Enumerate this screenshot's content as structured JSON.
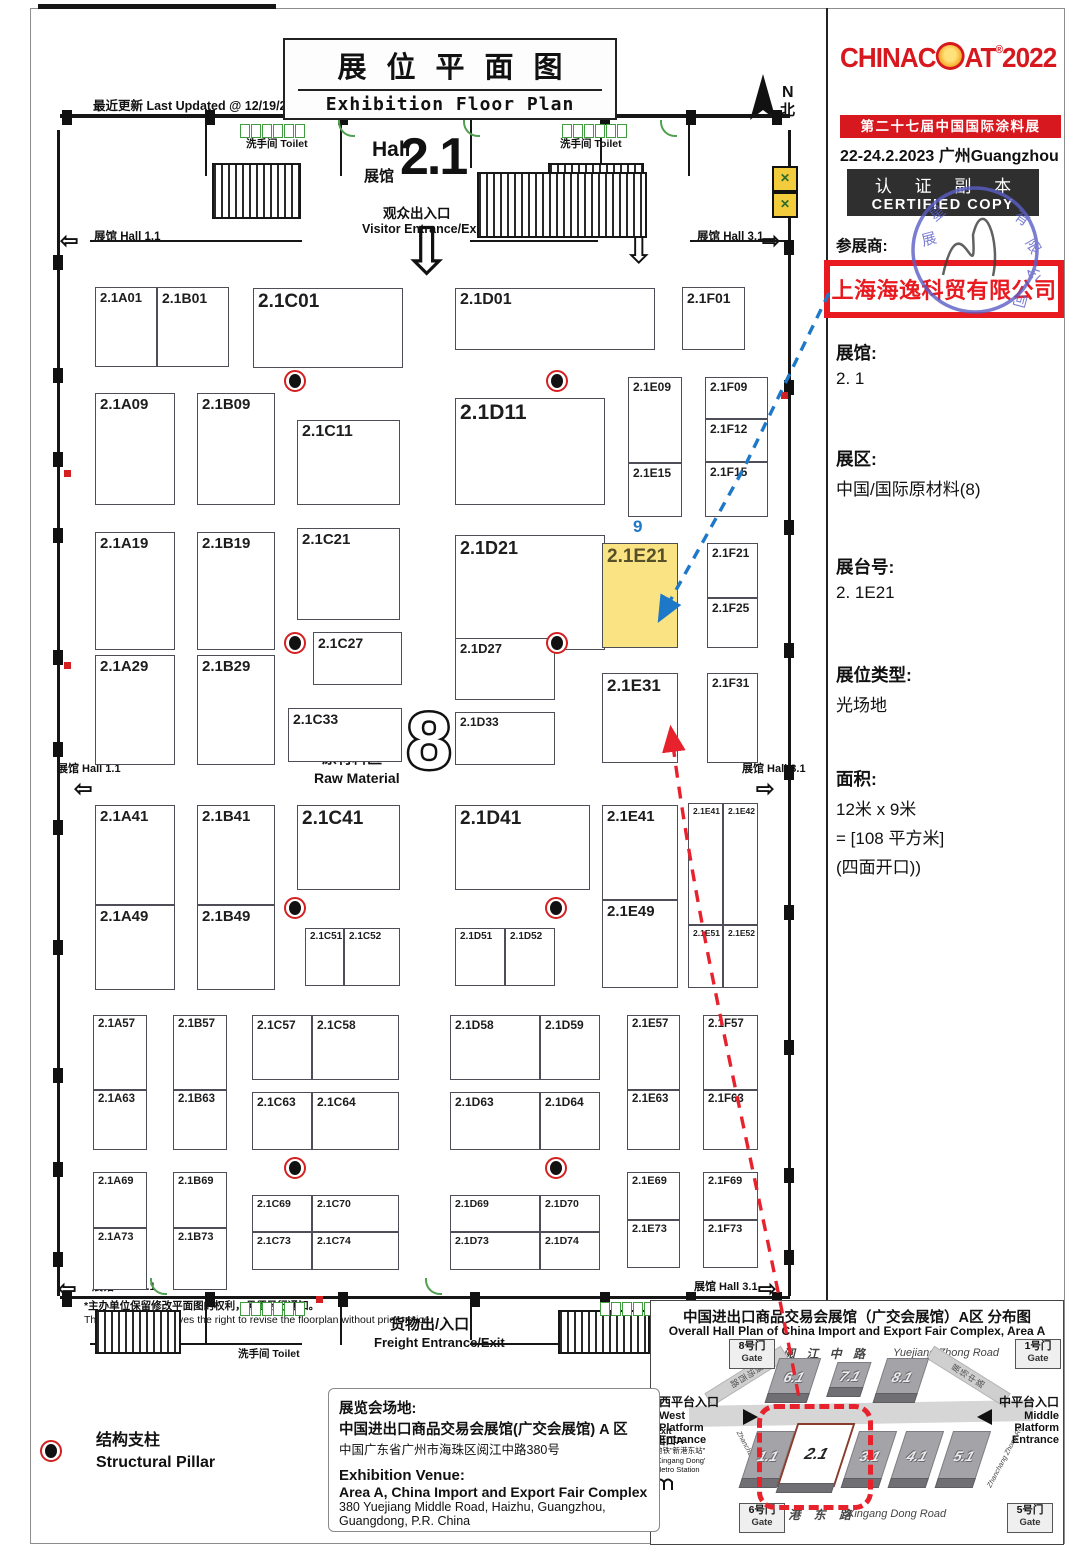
{
  "header": {
    "last_updated": "最近更新 Last Updated @ 12/19/2022",
    "title_cn": "展位平面图",
    "title_en": "Exhibition Floor Plan",
    "hall_word": "Hall",
    "hall_word_cn": "展馆",
    "hall_number": "2.1",
    "visitor_cn": "观众出入口",
    "visitor_en": "Visitor Entrance/Exit",
    "north_n": "N",
    "north_cn": "北"
  },
  "nav": {
    "hall11": "展馆 Hall 1.1",
    "hall31": "展馆 Hall 3.1"
  },
  "floorplan": {
    "toilet": "洗手间  Toilet",
    "freight_cn": "货物出/入口",
    "freight_en": "Freight Entrance/Exit",
    "zone_number": "8",
    "zone_cn": "原材料区",
    "zone_en": "Raw Material",
    "dim_top": "9",
    "dim_left": "12",
    "booths": [
      [
        "2.1A01",
        95,
        287,
        62,
        80,
        13
      ],
      [
        "2.1B01",
        157,
        287,
        72,
        80,
        14
      ],
      [
        "2.1C01",
        253,
        288,
        150,
        80,
        19
      ],
      [
        "2.1D01",
        455,
        288,
        200,
        62,
        16
      ],
      [
        "2.1F01",
        682,
        287,
        63,
        63,
        14
      ],
      [
        "2.1A09",
        95,
        393,
        80,
        112,
        15
      ],
      [
        "2.1B09",
        197,
        393,
        78,
        112,
        15
      ],
      [
        "2.1C11",
        297,
        420,
        103,
        85,
        16
      ],
      [
        "2.1D11",
        455,
        398,
        150,
        107,
        21
      ],
      [
        "2.1E09",
        628,
        377,
        54,
        86,
        12
      ],
      [
        "2.1E15",
        628,
        463,
        54,
        54,
        12
      ],
      [
        "2.1F09",
        705,
        377,
        63,
        42,
        12
      ],
      [
        "2.1F12",
        705,
        419,
        63,
        43,
        12
      ],
      [
        "2.1F15",
        705,
        462,
        63,
        55,
        12
      ],
      [
        "2.1A19",
        95,
        532,
        80,
        118,
        15
      ],
      [
        "2.1B19",
        197,
        532,
        78,
        118,
        15
      ],
      [
        "2.1C21",
        297,
        528,
        103,
        92,
        15
      ],
      [
        "2.1D21",
        455,
        535,
        150,
        115,
        18
      ],
      [
        "2.1E21",
        602,
        543,
        76,
        105,
        19,
        1
      ],
      [
        "2.1F21",
        707,
        543,
        51,
        55,
        12
      ],
      [
        "2.1F25",
        707,
        598,
        51,
        50,
        12
      ],
      [
        "2.1A29",
        95,
        655,
        80,
        110,
        15
      ],
      [
        "2.1B29",
        197,
        655,
        78,
        110,
        15
      ],
      [
        "2.1C27",
        313,
        632,
        89,
        53,
        14
      ],
      [
        "2.1C33",
        288,
        708,
        114,
        54,
        14
      ],
      [
        "2.1D27",
        455,
        638,
        100,
        62,
        13
      ],
      [
        "2.1D33",
        455,
        712,
        100,
        53,
        12
      ],
      [
        "2.1E31",
        602,
        673,
        76,
        90,
        17
      ],
      [
        "2.1F31",
        707,
        673,
        51,
        90,
        12
      ],
      [
        "2.1A41",
        95,
        805,
        80,
        100,
        15
      ],
      [
        "2.1A49",
        95,
        905,
        80,
        85,
        15
      ],
      [
        "2.1B41",
        197,
        805,
        78,
        100,
        15
      ],
      [
        "2.1B49",
        197,
        905,
        78,
        85,
        15
      ],
      [
        "2.1C41",
        297,
        805,
        103,
        85,
        19
      ],
      [
        "2.1C51",
        305,
        928,
        39,
        58,
        10
      ],
      [
        "2.1C52",
        344,
        928,
        56,
        58,
        10
      ],
      [
        "2.1D41",
        455,
        805,
        135,
        85,
        19
      ],
      [
        "2.1D51",
        455,
        928,
        50,
        58,
        10
      ],
      [
        "2.1D52",
        505,
        928,
        50,
        58,
        10
      ],
      [
        "2.1E41",
        602,
        805,
        76,
        95,
        15
      ],
      [
        "2.1E49",
        602,
        900,
        76,
        88,
        15
      ],
      [
        "2.1E41",
        688,
        803,
        35,
        122,
        8.5
      ],
      [
        "2.1E42",
        723,
        803,
        35,
        122,
        8.5
      ],
      [
        "2.1E51",
        688,
        925,
        35,
        63,
        8.5
      ],
      [
        "2.1E52",
        723,
        925,
        35,
        63,
        8.5
      ],
      [
        "2.1A57",
        93,
        1015,
        54,
        75,
        11.5
      ],
      [
        "2.1A63",
        93,
        1090,
        54,
        60,
        11.5
      ],
      [
        "2.1B57",
        173,
        1015,
        54,
        75,
        11.5
      ],
      [
        "2.1B63",
        173,
        1090,
        54,
        60,
        11.5
      ],
      [
        "2.1C57",
        252,
        1015,
        60,
        65,
        12
      ],
      [
        "2.1C58",
        312,
        1015,
        87,
        65,
        12
      ],
      [
        "2.1C63",
        252,
        1092,
        60,
        58,
        12
      ],
      [
        "2.1C64",
        312,
        1092,
        87,
        58,
        12
      ],
      [
        "2.1D58",
        450,
        1015,
        90,
        65,
        12
      ],
      [
        "2.1D59",
        540,
        1015,
        60,
        65,
        12
      ],
      [
        "2.1D63",
        450,
        1092,
        90,
        58,
        12
      ],
      [
        "2.1D64",
        540,
        1092,
        60,
        58,
        12
      ],
      [
        "2.1E57",
        627,
        1015,
        53,
        75,
        11.5
      ],
      [
        "2.1E63",
        627,
        1090,
        53,
        60,
        11.5
      ],
      [
        "2.1F57",
        703,
        1015,
        55,
        75,
        11.5
      ],
      [
        "2.1F63",
        703,
        1090,
        55,
        60,
        11.5
      ],
      [
        "2.1A69",
        93,
        1172,
        54,
        56,
        11
      ],
      [
        "2.1A73",
        93,
        1228,
        54,
        62,
        11
      ],
      [
        "2.1B69",
        173,
        1172,
        54,
        56,
        11
      ],
      [
        "2.1B73",
        173,
        1228,
        54,
        62,
        11
      ],
      [
        "2.1C69",
        252,
        1195,
        60,
        37,
        10.5
      ],
      [
        "2.1C70",
        312,
        1195,
        87,
        37,
        10.5
      ],
      [
        "2.1C73",
        252,
        1232,
        60,
        38,
        10.5
      ],
      [
        "2.1C74",
        312,
        1232,
        87,
        38,
        10.5
      ],
      [
        "2.1D69",
        450,
        1195,
        90,
        37,
        10.5
      ],
      [
        "2.1D70",
        540,
        1195,
        60,
        37,
        10.5
      ],
      [
        "2.1D73",
        450,
        1232,
        90,
        38,
        10.5
      ],
      [
        "2.1D74",
        540,
        1232,
        60,
        38,
        10.5
      ],
      [
        "2.1E69",
        627,
        1172,
        53,
        48,
        11
      ],
      [
        "2.1E73",
        627,
        1220,
        53,
        48,
        11
      ],
      [
        "2.1F69",
        703,
        1172,
        55,
        48,
        11
      ],
      [
        "2.1F73",
        703,
        1220,
        55,
        48,
        11
      ]
    ],
    "pillars": [
      [
        295,
        381
      ],
      [
        557,
        381
      ],
      [
        295,
        643
      ],
      [
        557,
        643
      ],
      [
        295,
        908
      ],
      [
        556,
        908
      ],
      [
        295,
        1168
      ],
      [
        556,
        1168
      ]
    ]
  },
  "legend": {
    "pillar_cn": "结构支柱",
    "pillar_en": "Structural Pillar"
  },
  "footnote": {
    "cn": "*主办单位保留修改平面图的权利，毋须另行通知。",
    "en": "The Organizer reserves the right to revise the floorplan without prior notice."
  },
  "venue": {
    "cn_label": "展览会场地:",
    "cn_line1": "中国进出口商品交易会展馆(广交会展馆) A 区",
    "cn_line2": "中国广东省广州市海珠区阅江中路380号",
    "en_label": "Exhibition Venue:",
    "en_line1": "Area A, China Import and Export Fair Complex",
    "en_line2": "380 Yuejiang Middle Road, Haizhu, Guangzhou,",
    "en_line3": "Guangdong, P.R. China"
  },
  "sidebar": {
    "logo_left": "CHINAC",
    "logo_right": "AT",
    "logo_reg": "®",
    "logo_year": "2022",
    "logo_sub": "第二十七届中国国际涂料展",
    "date_line": "22-24.2.2023 广州Guangzhou",
    "certified_cn": "认 证 副 本",
    "certified_en": "CERTIFIED COPY",
    "exhibitor_label": "参展商:",
    "company": "上海海逸科贸有限公司",
    "fields": [
      {
        "label": "展馆:",
        "lines": [
          "2. 1"
        ]
      },
      {
        "label": "展区:",
        "lines": [
          "中国/国际原材料(8)"
        ]
      },
      {
        "label": "展台号:",
        "lines": [
          "2. 1E21"
        ]
      },
      {
        "label": "展位类型:",
        "lines": [
          "光场地"
        ]
      },
      {
        "label": "面积:",
        "lines": [
          "12米 x 9米",
          "= [108 平方米]",
          "(四面开口))"
        ]
      }
    ]
  },
  "minimap": {
    "title_cn": "中国进出口商品交易会展馆（广交会展馆）A区 分布图",
    "title_en": "Overall Hall Plan of China Import and Export Fair Complex, Area A",
    "gate_tl": {
      "cn": "8号门",
      "en": "Gate"
    },
    "gate_tr": {
      "cn": "1号门",
      "en": "Gate"
    },
    "gate_bl": {
      "cn": "6号门",
      "en": "Gate"
    },
    "gate_br": {
      "cn": "5号门",
      "en": "Gate"
    },
    "road_top_cn": "阅 江 中 路",
    "road_top_en": "Yuejiang Zhong Road",
    "promenade_cn": "珠 江 散 步 道",
    "promenade_en": "Pearl Promenade",
    "road_bottom_cn": "新 港 东 路",
    "road_bottom_en": "Xingang Dong Road",
    "side_left_cn": "展场西路",
    "side_left_en": "Zhanchang Xi Rd.",
    "side_right_cn": "展场中路",
    "side_right_en": "Zhanchang Zhong Rd.",
    "west_cn": "西平台入口",
    "west_en": [
      "West",
      "Platform",
      "Entrance"
    ],
    "mid_cn": "中平台入口",
    "mid_en": [
      "Middle",
      "Platform",
      "Entrance"
    ],
    "exit_en": "Exit",
    "exit_cn": "出口A",
    "metro1": "地铁\"新港东站\"",
    "metro2": "'Xingang Dong'",
    "metro3": "Metro Station",
    "halls_top": [
      "6.1",
      "7.1",
      "8.1"
    ],
    "halls_bottom": [
      "1.1",
      "2.1",
      "3.1",
      "4.1",
      "5.1"
    ],
    "highlight_hall": "2.1"
  },
  "colors": {
    "accent_red": "#e8222d",
    "accent_blue": "#1e78c8",
    "highlight_yellow": "#fae382",
    "logo_red": "#d7181f"
  }
}
